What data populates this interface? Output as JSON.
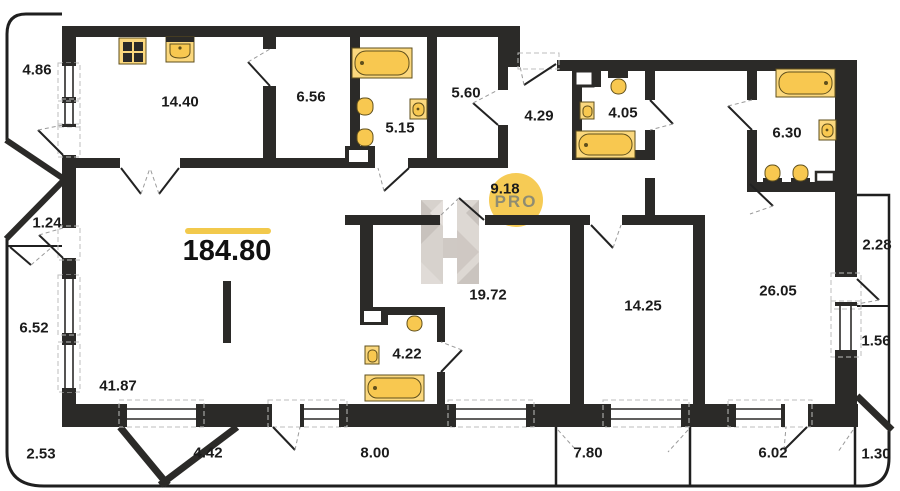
{
  "plan": {
    "total_area": "184.80",
    "watermark": {
      "letter": "H",
      "badge": "PRO"
    },
    "areas": {
      "a486": "4.86",
      "a1440": "14.40",
      "a656": "6.56",
      "a515": "5.15",
      "a560": "5.60",
      "a429": "4.29",
      "a405": "4.05",
      "a630": "6.30",
      "a918": "9.18",
      "a124": "1.24",
      "a652": "6.52",
      "a4187": "41.87",
      "a1972": "19.72",
      "a422": "4.22",
      "a1425": "14.25",
      "a2605": "26.05",
      "a228": "2.28",
      "a156": "1.56",
      "a253": "2.53",
      "a442": "4.42",
      "a800": "8.00",
      "a780": "7.80",
      "a602": "6.02",
      "a130": "1.30"
    },
    "colors": {
      "wall": "#2b2a28",
      "accent_line": "#F2C94C",
      "fixture": "#F8C850",
      "fixture_pad": "#FBD87E",
      "badge": "#F6CB55",
      "badge_text": "#8F8C72",
      "watermark_gray": "#D8D3CE"
    }
  }
}
